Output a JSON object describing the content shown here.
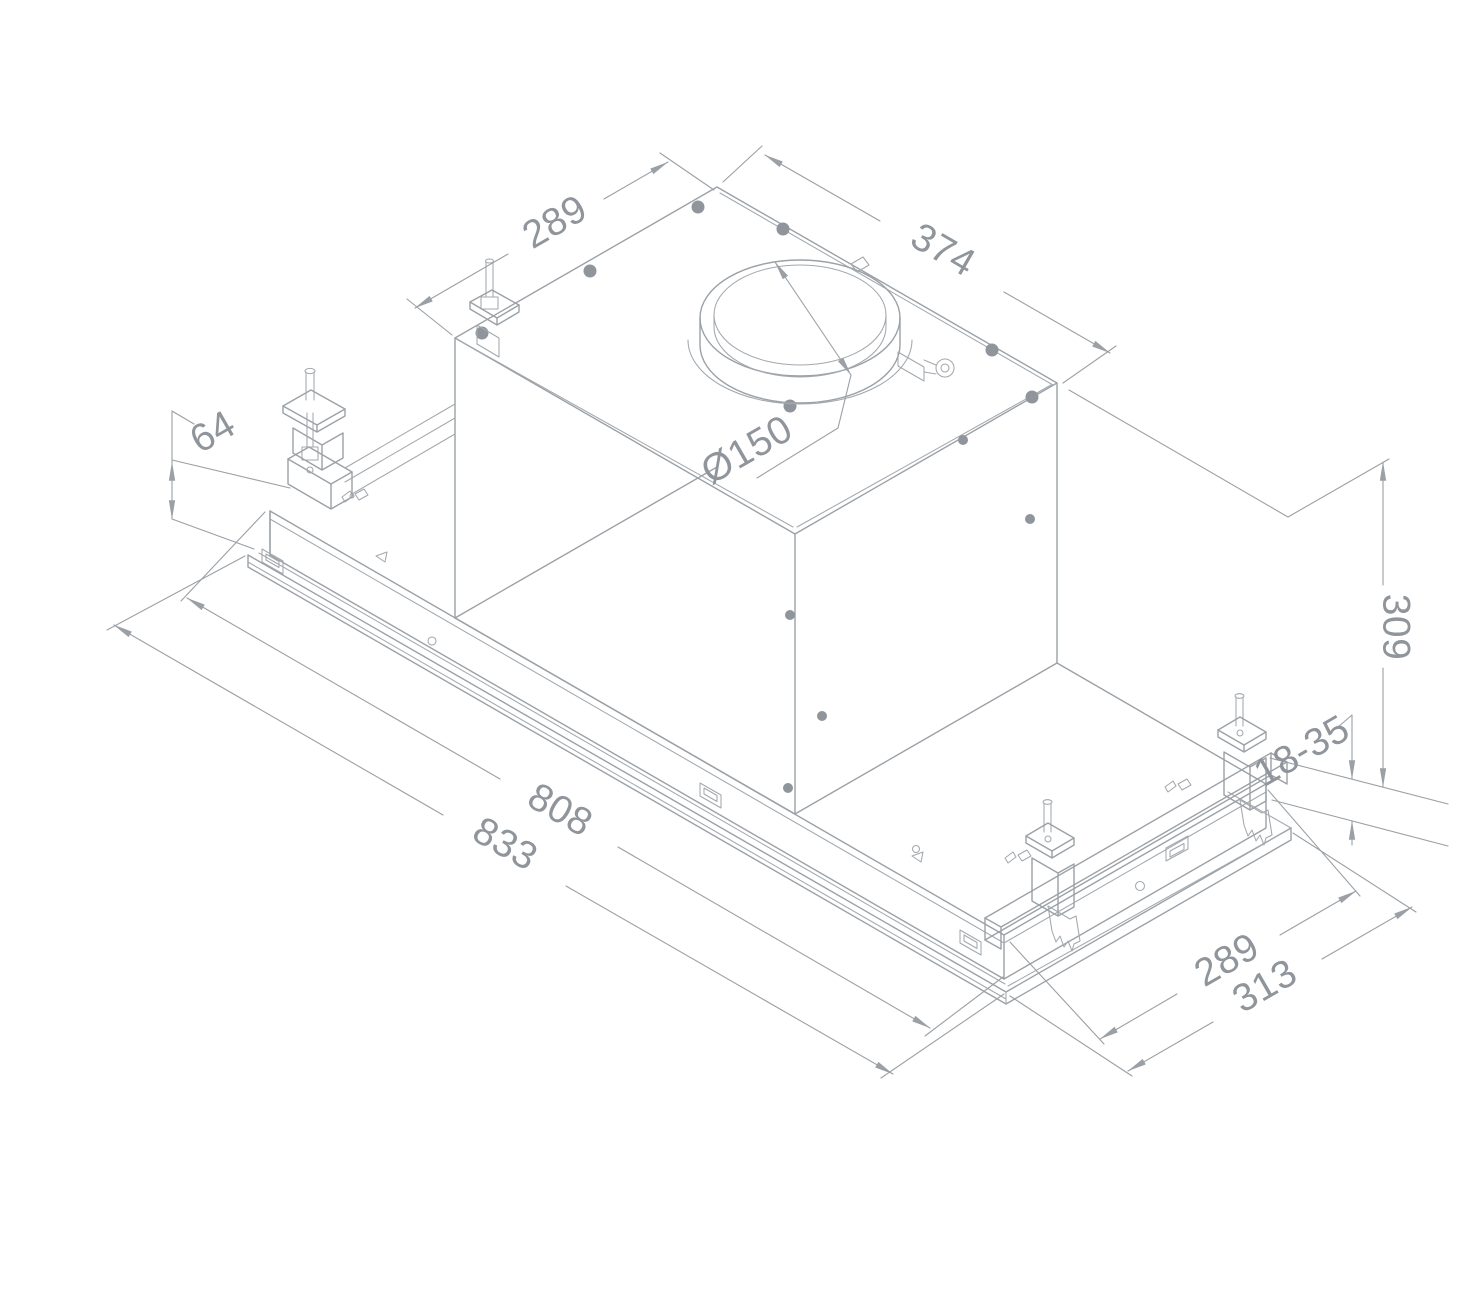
{
  "drawing": {
    "kind": "isometric-installation-diagram",
    "subject": "built-in ceiling cooker hood with mounting brackets",
    "colors": {
      "line": "#9ba1a6",
      "text": "#8f959b",
      "background": "#ffffff"
    },
    "dimensions": {
      "top_depth": {
        "label": "289"
      },
      "top_length": {
        "label": "374"
      },
      "duct_diameter": {
        "label": "Ø150"
      },
      "left_height": {
        "label": "64"
      },
      "total_height": {
        "label": "309"
      },
      "adjust_range": {
        "label": "18-35"
      },
      "body_length": {
        "label": "808"
      },
      "overall_length": {
        "label": "833"
      },
      "right_depth": {
        "label": "289"
      },
      "overall_depth": {
        "label": "313"
      }
    }
  }
}
